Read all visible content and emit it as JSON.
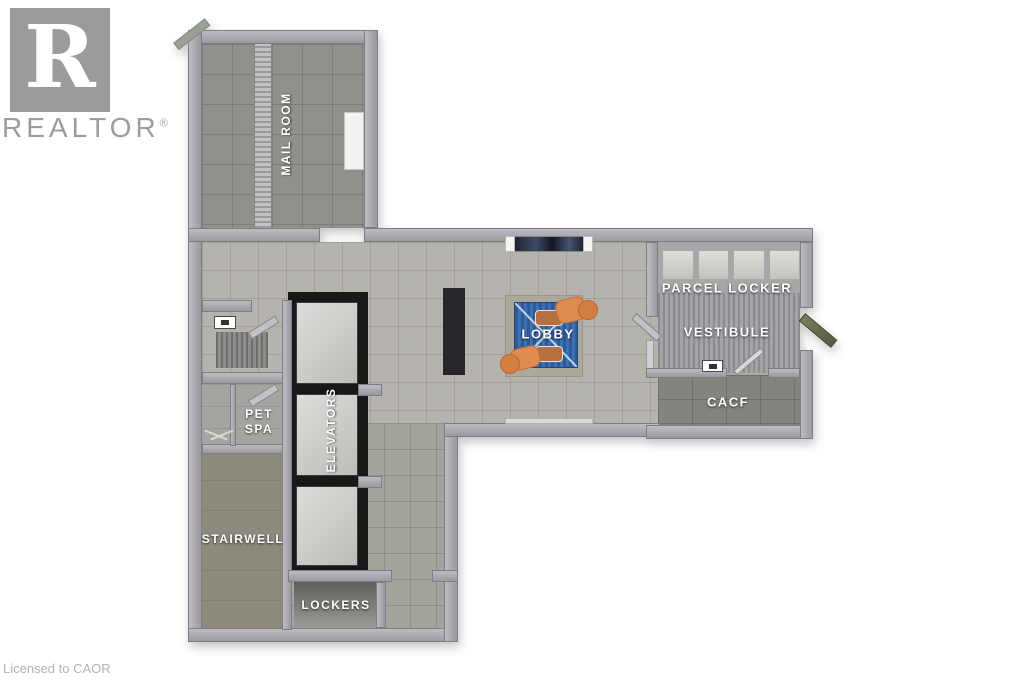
{
  "branding": {
    "logo_letter": "R",
    "name": "REALTOR",
    "registered": "®"
  },
  "footer": {
    "license": "Licensed to CAOR"
  },
  "rooms": {
    "mail_room": {
      "label": "MAIL ROOM"
    },
    "pet_spa": {
      "line1": "PET",
      "line2": "SPA"
    },
    "elevators": {
      "label": "ELEVATORS"
    },
    "stairwell": {
      "label": "STAIRWELL"
    },
    "lockers": {
      "label": "LOCKERS"
    },
    "lobby": {
      "label": "LOBBY"
    },
    "parcel_locker": {
      "label": "PARCEL LOCKER"
    },
    "vestibule": {
      "label": "VESTIBULE"
    },
    "cacf": {
      "label": "CACF"
    }
  },
  "colors": {
    "wall": "#a6a6ac",
    "floor_light": "#b5b3ae",
    "floor_dark": "#90908d",
    "stairwell_floor": "#8e897f",
    "cacf_floor": "#84847f",
    "elevator_shaft": "#181818",
    "elevator_cab": "#d2d2cf",
    "rug_blue": "#3365a5",
    "chair_orange": "#de8c52",
    "desk_dark": "#26262b",
    "brand_gray": "#9c9c9c",
    "label_white": "#ffffff"
  }
}
